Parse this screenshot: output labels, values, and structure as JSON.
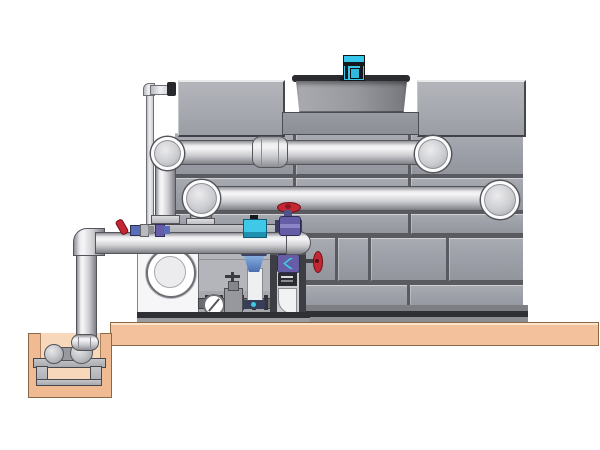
{
  "scene": {
    "description": "Side-view technical illustration of a fluid cooler / cooling tower with external pump skid, piping, valves, concrete pad and sump pit",
    "components": [
      {
        "name": "cooling-tower",
        "detail": "large gray paneled casing with brick-pattern panels and dark base channel"
      },
      {
        "name": "fan-cowl",
        "detail": "tapered gray cylinder recessed between two top casing boxes"
      },
      {
        "name": "fan-motor",
        "detail": "small cyan motor on top of the fan cowl"
      },
      {
        "name": "makeup-water-line",
        "detail": "thin vertical pipe entering upper left casing via flange"
      },
      {
        "name": "upper-supply-pipe",
        "detail": "large horizontal pipe with left down-elbow, mid coupling sleeve, ball end entering casing"
      },
      {
        "name": "middle-return-pipe",
        "detail": "large horizontal pipe with ball elbow at left and ball end entering casing"
      },
      {
        "name": "discharge-header-pipe",
        "detail": "lower horizontal pipe from left riser elbow to domed cap above pump"
      },
      {
        "name": "riser-pipe",
        "detail": "vertical pipe descending from header into sump pit"
      },
      {
        "name": "pump",
        "detail": "white end-suction pump with circular suction flange"
      },
      {
        "name": "equipment-bay",
        "detail": "gray bay with small pipework, sight glass and gate valve"
      },
      {
        "name": "valve-frame-column",
        "detail": "steel frame with butterfly valve, label plate and white drain elbow"
      },
      {
        "name": "butterfly-valve",
        "detail": "purple valve with cyan disc indicator"
      },
      {
        "name": "side-handwheel-valve",
        "detail": "red handwheel on stem projecting right of frame"
      },
      {
        "name": "globe-valve",
        "detail": "purple globe valve with round red handwheel on header pipe"
      },
      {
        "name": "header-ball-valve",
        "detail": "small red lever valve with blue fittings on header pipe"
      },
      {
        "name": "injection-branch",
        "detail": "cyan instrument head and blue cone nozzle with white drop pipe"
      },
      {
        "name": "sight-glass",
        "detail": "round glass with diagonal flapper line"
      },
      {
        "name": "gate-valve",
        "detail": "small gate valve with cross stem handle"
      },
      {
        "name": "concrete-platform",
        "detail": "tan equipment pad slab"
      },
      {
        "name": "sump-pit",
        "detail": "tan pit with lighter interior at lower left"
      },
      {
        "name": "sump-pump",
        "detail": "two-sphere pump unit on steel stand inside pit"
      }
    ]
  },
  "colors": {
    "bg": "#ffffff",
    "tower_seam": "#595b61",
    "tower_panel": "#9da0a8",
    "tower_box": "#a7a9b0",
    "cowl_rim": "#2a2c30",
    "motor_cyan": "#35c6ea",
    "motor_dark": "#15181c",
    "pipe_light": "#f5f5f7",
    "pipe_dark": "#7e7f85",
    "ring_white": "#fbfbfc",
    "platform_tan": "#f3c19c",
    "pit_wall": "#f0ba92",
    "pit_inner": "#f8d8bb",
    "valve_red": "#c42634",
    "valve_purple": "#665da6",
    "valve_blue": "#4a6fb0",
    "accent_cyan": "#3fc8e8",
    "pump_white": "#f6f6f8",
    "steel_dark": "#3a3c41"
  }
}
